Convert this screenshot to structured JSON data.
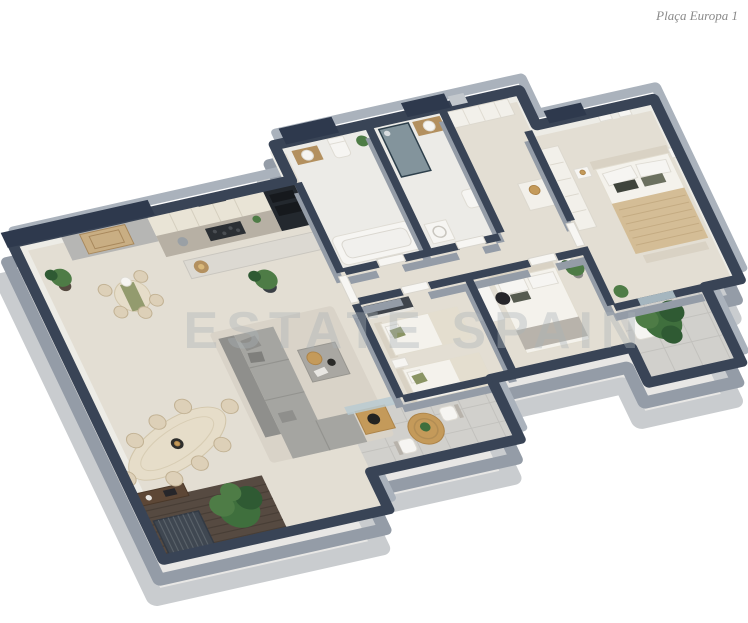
{
  "page": {
    "title": "Plaça Europa 1",
    "watermark": "ESTATE SPAIN"
  },
  "palette": {
    "bg": "#ffffff",
    "wallTop": "#394456",
    "wallTopDark": "#2e394d",
    "wallSide": "#949ca7",
    "wallSideLight": "#aab2bc",
    "plinth": "#c9cccf",
    "plinthFill": "#e8e7e5",
    "floor": "#e3ded3",
    "floorBath": "#ecebe7",
    "floorOutdoor": "#d1d0cc",
    "innerFace": "#edece6",
    "deck": "#564a41",
    "cabinet": "#e9e4d6",
    "counter": "#b7b0a4",
    "appliance": "#23282e",
    "island": "#dcd9d2",
    "wood": "#b3905f",
    "tableCream": "#e6ddc9",
    "chairCream": "#ddd0b8",
    "sofa": "#a5a5a1",
    "sofaDark": "#8f8f8c",
    "rug": "#d9d3c8",
    "stone": "#a9a7a2",
    "gold": "#c49a5a",
    "black": "#26262a",
    "bedWhite": "#f4f2ec",
    "bedTrim": "#d9d2c4",
    "blanketTan": "#d4bd96",
    "throwGray": "#b8b3ab",
    "pillowGreen": "#8a9464",
    "wardrobe": "#f2f0ea",
    "glass": "#b9cad1",
    "showerGlass": "#3d5a6b",
    "plant": "#4e7c46",
    "plantMid": "#3f6f3d",
    "plantDark": "#2f5a33",
    "pot": "#3a3f45",
    "ac": "#3f4751",
    "console": "#5d4736",
    "doorWhite": "#f7f6f3",
    "grayFace": "#b6b6b4",
    "art": "#c9ae83",
    "title": "#8a8a8a",
    "watermark": "#aab3b8"
  }
}
